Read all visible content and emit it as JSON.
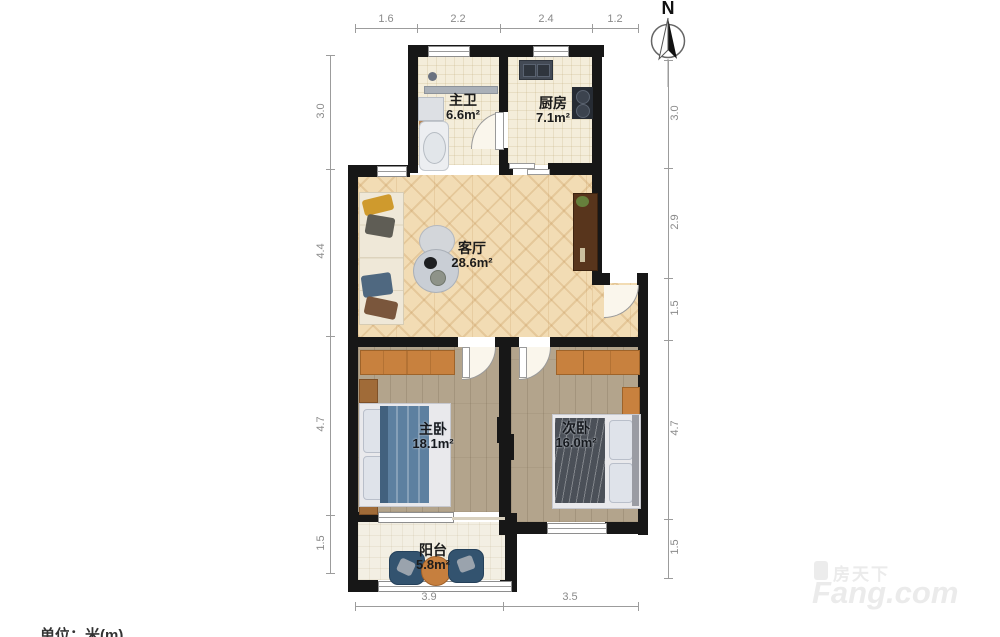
{
  "meta": {
    "north_label": "N",
    "units_label": "单位：米(m)"
  },
  "watermark": {
    "brand_cn": "房天下",
    "brand_en": "Fang.com"
  },
  "rooms": [
    {
      "id": "master-bath",
      "name": "主卫",
      "area": "6.6m²"
    },
    {
      "id": "kitchen",
      "name": "厨房",
      "area": "7.1m²"
    },
    {
      "id": "living-room",
      "name": "客厅",
      "area": "28.6m²"
    },
    {
      "id": "master-bedroom",
      "name": "主卧",
      "area": "18.1m²"
    },
    {
      "id": "second-bedroom",
      "name": "次卧",
      "area": "16.0m²"
    },
    {
      "id": "balcony",
      "name": "阳台",
      "area": "5.8m²"
    }
  ],
  "dimensions": {
    "top": [
      "1.6",
      "2.2",
      "2.4",
      "1.2"
    ],
    "bottom": [
      "3.9",
      "3.5"
    ],
    "left": [
      "3.0",
      "4.4",
      "4.7",
      "1.5"
    ],
    "right": [
      "3.0",
      "2.9",
      "1.5",
      "4.7",
      "1.5"
    ]
  }
}
